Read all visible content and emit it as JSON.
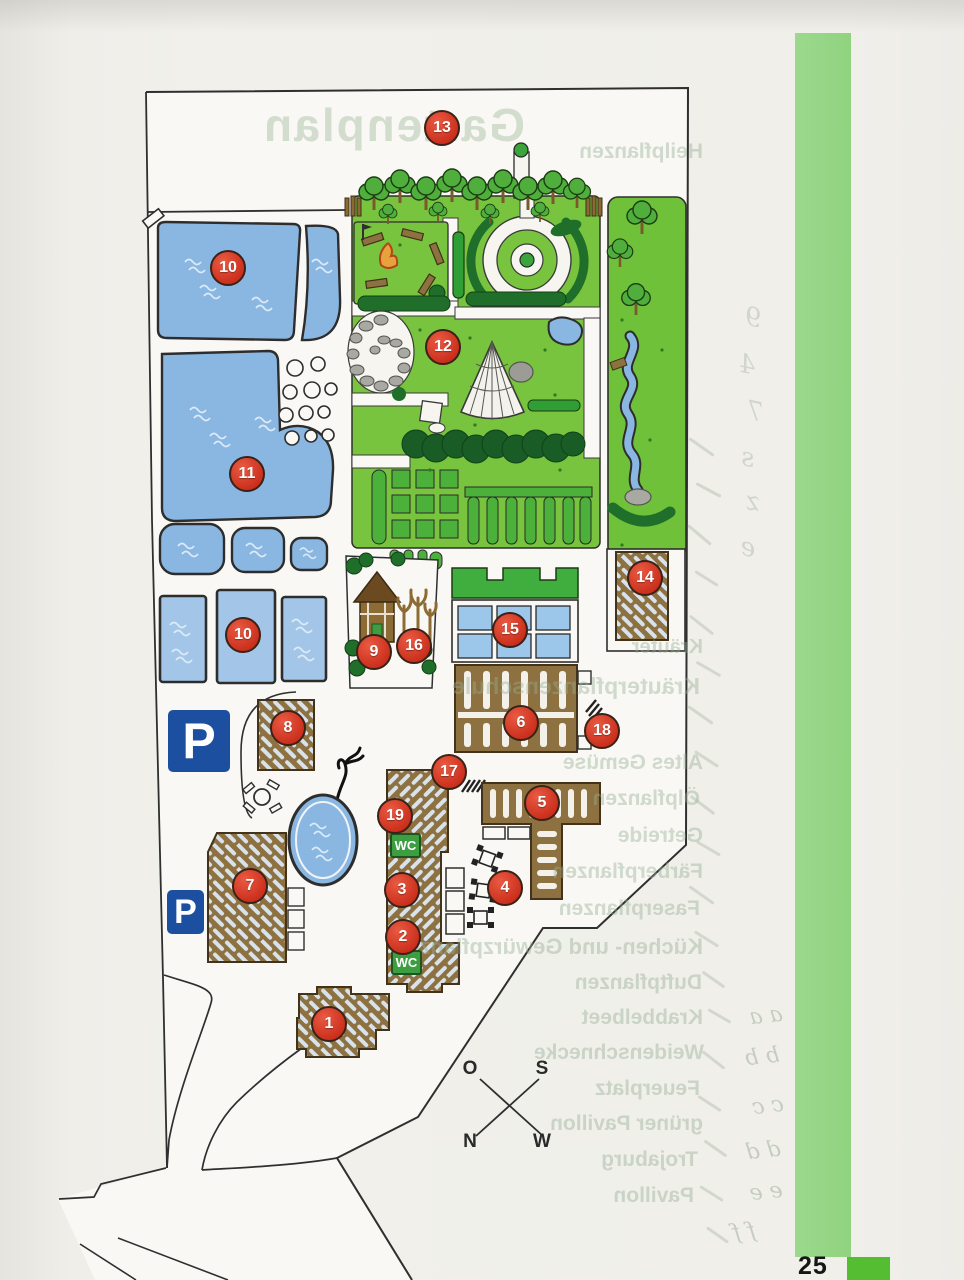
{
  "page": {
    "number": "25"
  },
  "showthrough": {
    "title": "Gartenplan",
    "words": [
      {
        "text": "Heilpflanzen",
        "x": 703,
        "y": 152,
        "fs": 21
      },
      {
        "text": "Kräuter",
        "x": 703,
        "y": 648,
        "fs": 20
      },
      {
        "text": "Kräuterpflanzenschule",
        "x": 700,
        "y": 685,
        "fs": 23
      },
      {
        "text": "Altes Gemüse",
        "x": 703,
        "y": 763,
        "fs": 21
      },
      {
        "text": "Ölpflanzen",
        "x": 700,
        "y": 799,
        "fs": 21
      },
      {
        "text": "Getreide",
        "x": 703,
        "y": 836,
        "fs": 21
      },
      {
        "text": "Färberpflanzen",
        "x": 703,
        "y": 872,
        "fs": 21
      },
      {
        "text": "Faserpflanzen",
        "x": 700,
        "y": 909,
        "fs": 21
      },
      {
        "text": "Küchen- und Gewürzpflanzen",
        "x": 703,
        "y": 946,
        "fs": 22
      },
      {
        "text": "Duftpflanzen",
        "x": 702,
        "y": 983,
        "fs": 21
      },
      {
        "text": "Krabbelbeet",
        "x": 703,
        "y": 1018,
        "fs": 21
      },
      {
        "text": "Weidenschnecke",
        "x": 704,
        "y": 1053,
        "fs": 21
      },
      {
        "text": "Feuerplatz",
        "x": 700,
        "y": 1089,
        "fs": 21
      },
      {
        "text": "grüner Pavillon",
        "x": 703,
        "y": 1124,
        "fs": 21
      },
      {
        "text": "Trojaburg",
        "x": 698,
        "y": 1160,
        "fs": 21
      },
      {
        "text": "Pavillon",
        "x": 694,
        "y": 1196,
        "fs": 21
      }
    ]
  },
  "map": {
    "markers": [
      {
        "label": "13",
        "x": 442,
        "y": 128
      },
      {
        "label": "10",
        "x": 228,
        "y": 268
      },
      {
        "label": "12",
        "x": 443,
        "y": 347
      },
      {
        "label": "11",
        "x": 247,
        "y": 474
      },
      {
        "label": "10",
        "x": 243,
        "y": 635
      },
      {
        "label": "14",
        "x": 645,
        "y": 578
      },
      {
        "label": "15",
        "x": 510,
        "y": 630
      },
      {
        "label": "9",
        "x": 374,
        "y": 652
      },
      {
        "label": "16",
        "x": 414,
        "y": 646
      },
      {
        "label": "6",
        "x": 521,
        "y": 723
      },
      {
        "label": "18",
        "x": 602,
        "y": 731
      },
      {
        "label": "8",
        "x": 288,
        "y": 728
      },
      {
        "label": "17",
        "x": 449,
        "y": 772
      },
      {
        "label": "5",
        "x": 542,
        "y": 803
      },
      {
        "label": "19",
        "x": 395,
        "y": 816
      },
      {
        "label": "3",
        "x": 402,
        "y": 890
      },
      {
        "label": "4",
        "x": 505,
        "y": 888
      },
      {
        "label": "2",
        "x": 403,
        "y": 937
      },
      {
        "label": "7",
        "x": 250,
        "y": 886
      },
      {
        "label": "1",
        "x": 329,
        "y": 1024
      }
    ],
    "wc_labels": [
      {
        "text": "WC",
        "x": 390,
        "y": 833
      },
      {
        "text": "WC",
        "x": 391,
        "y": 950
      }
    ],
    "parking": [
      {
        "text": "P",
        "x": 168,
        "y": 710,
        "w": 62,
        "h": 62,
        "fs": 50
      },
      {
        "text": "P",
        "x": 167,
        "y": 890,
        "w": 37,
        "h": 44,
        "fs": 34
      }
    ],
    "compass": {
      "o": "O",
      "s": "S",
      "n": "N",
      "w": "W"
    }
  },
  "handwriting": {
    "pairs": [
      {
        "text": "a a",
        "x": 766,
        "y": 1016
      },
      {
        "text": "b b",
        "x": 762,
        "y": 1057
      },
      {
        "text": "c c",
        "x": 768,
        "y": 1106
      },
      {
        "text": "d d",
        "x": 763,
        "y": 1151
      },
      {
        "text": "e e",
        "x": 766,
        "y": 1192
      },
      {
        "text": "f f",
        "x": 744,
        "y": 1232
      }
    ],
    "glyphs": [
      {
        "g": "9",
        "x": 753,
        "y": 318
      },
      {
        "g": "4",
        "x": 747,
        "y": 365
      },
      {
        "g": "7",
        "x": 755,
        "y": 412
      },
      {
        "g": "s",
        "x": 748,
        "y": 458
      },
      {
        "g": "z",
        "x": 753,
        "y": 502
      },
      {
        "g": "e",
        "x": 748,
        "y": 548
      }
    ],
    "strokes": [
      {
        "x": 700,
        "y": 432,
        "len": 30,
        "rot": -55
      },
      {
        "x": 707,
        "y": 476,
        "len": 28,
        "rot": -62
      },
      {
        "x": 698,
        "y": 520,
        "len": 30,
        "rot": -50
      },
      {
        "x": 705,
        "y": 565,
        "len": 27,
        "rot": -58
      },
      {
        "x": 700,
        "y": 610,
        "len": 30,
        "rot": -52
      },
      {
        "x": 707,
        "y": 655,
        "len": 28,
        "rot": -60
      },
      {
        "x": 699,
        "y": 700,
        "len": 30,
        "rot": -55
      },
      {
        "x": 705,
        "y": 745,
        "len": 28,
        "rot": -57
      },
      {
        "x": 701,
        "y": 790,
        "len": 30,
        "rot": -53
      },
      {
        "x": 707,
        "y": 835,
        "len": 27,
        "rot": -60
      },
      {
        "x": 700,
        "y": 880,
        "len": 30,
        "rot": -55
      },
      {
        "x": 705,
        "y": 925,
        "len": 28,
        "rot": -58
      },
      {
        "x": 712,
        "y": 966,
        "len": 27,
        "rot": -55
      },
      {
        "x": 718,
        "y": 1003,
        "len": 26,
        "rot": -60
      },
      {
        "x": 712,
        "y": 1046,
        "len": 28,
        "rot": -52
      },
      {
        "x": 708,
        "y": 1090,
        "len": 27,
        "rot": -57
      },
      {
        "x": 714,
        "y": 1135,
        "len": 27,
        "rot": -55
      },
      {
        "x": 710,
        "y": 1180,
        "len": 27,
        "rot": -58
      },
      {
        "x": 716,
        "y": 1222,
        "len": 26,
        "rot": -55
      }
    ]
  },
  "colors": {
    "accent_stripe": "#8fd37f",
    "corner_square": "#55bd31",
    "water": "#8ab7e1",
    "water_light": "#a3c6e8",
    "lawn": "#79c43e",
    "hedge_medium": "#3aa53b",
    "hedge_dark": "#1f6f2b",
    "building_brown": "#8d7140",
    "marker_red": "#c92e1b",
    "parking_blue": "#1c4f9f",
    "wc_green": "#3c9e40"
  }
}
